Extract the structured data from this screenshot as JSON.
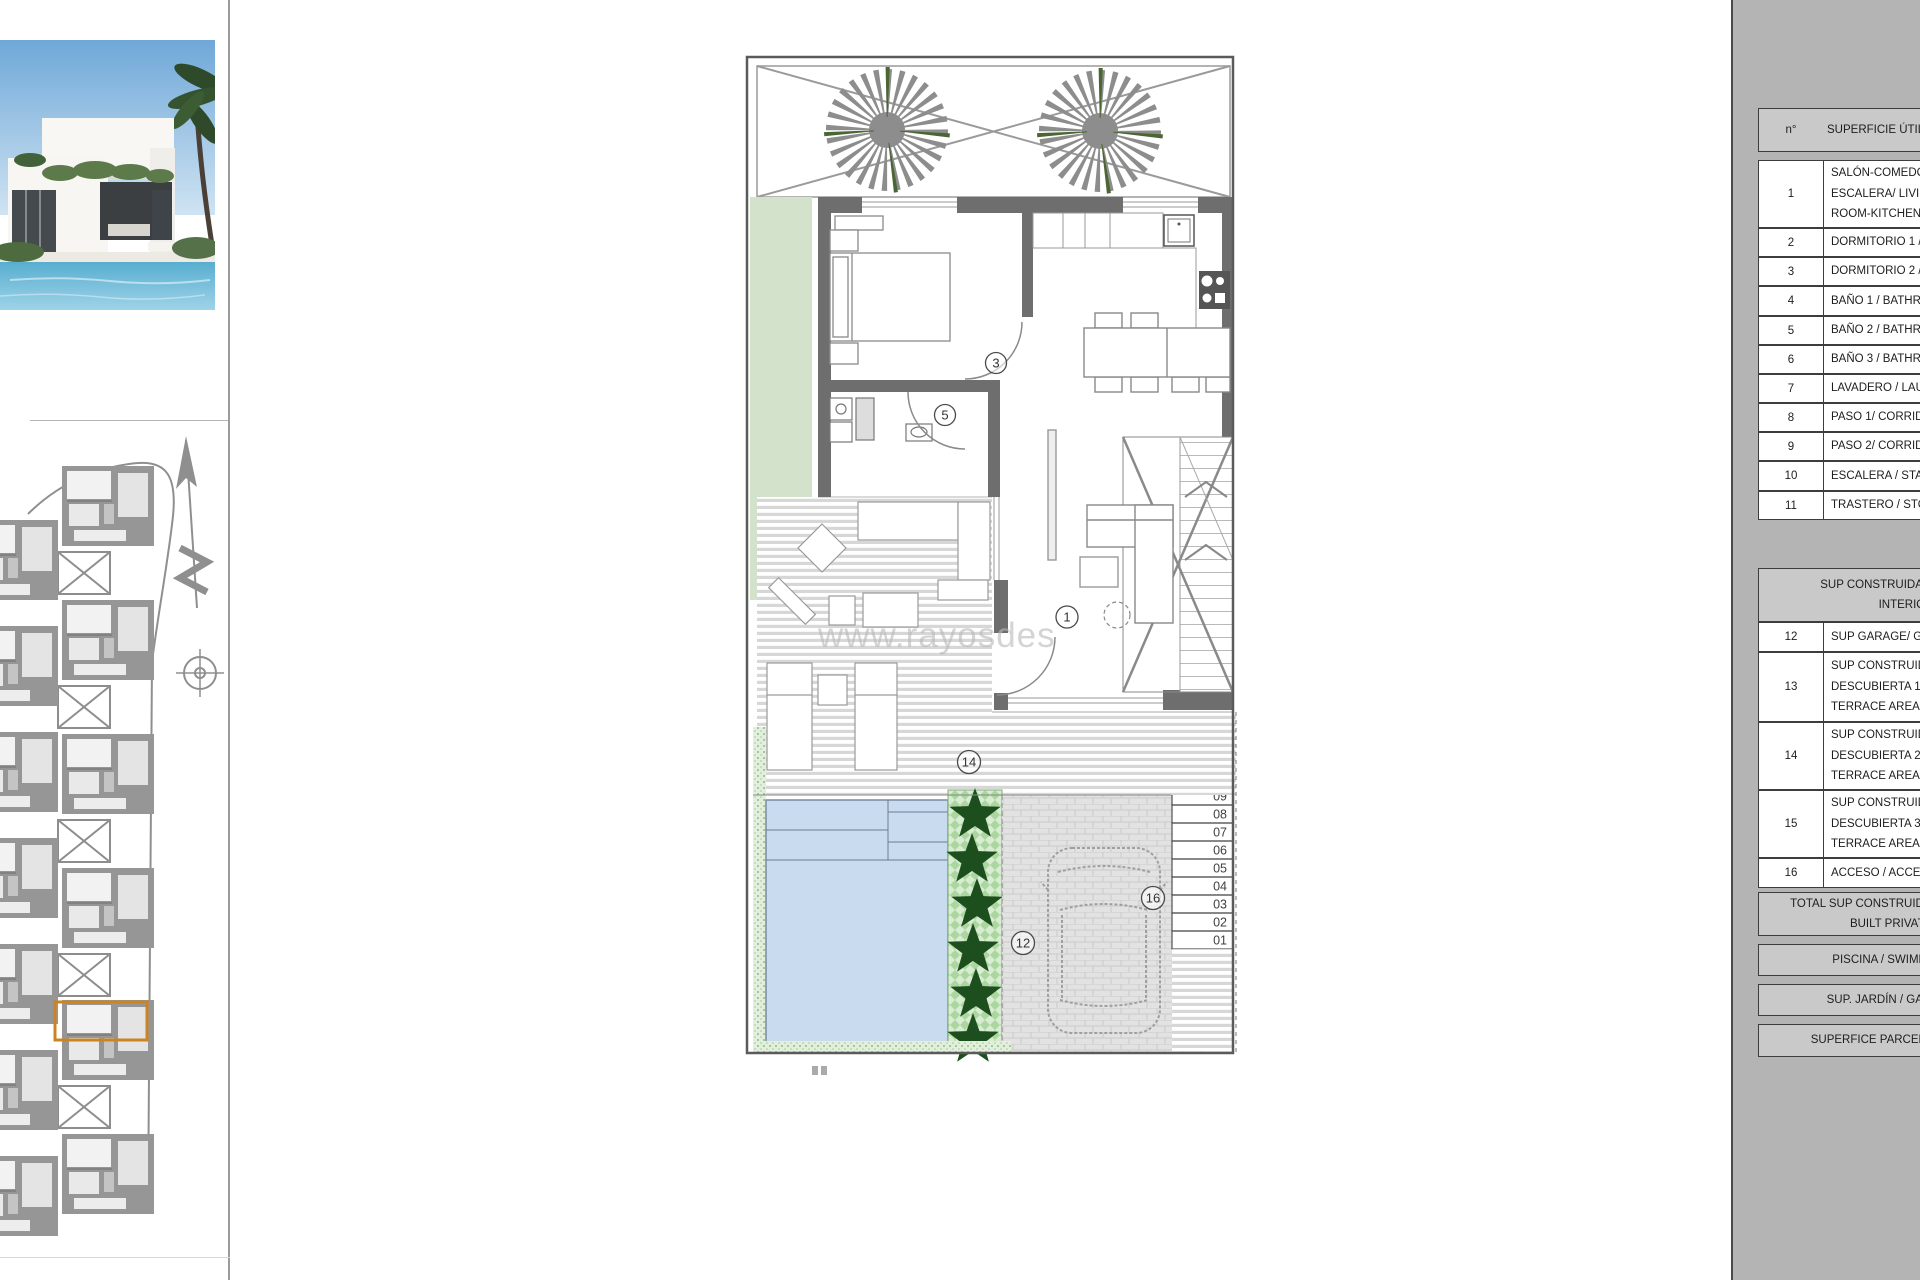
{
  "panel": {
    "header": {
      "num": "n°",
      "title": "SUPERFICIE ÚTIL / USEFUL AREA"
    },
    "rows": [
      {
        "n": "1",
        "lines": [
          "SALÓN-COMEDOR-COCINA-",
          "ESCALERA/ LIVING-DINING",
          "ROOM-KITCHEN-STAIRS"
        ]
      },
      {
        "n": "2",
        "lines": [
          "DORMITORIO 1 / BEDROOM 1"
        ]
      },
      {
        "n": "3",
        "lines": [
          "DORMITORIO 2 / BEDROOM 2"
        ]
      },
      {
        "n": "4",
        "lines": [
          "BAÑO 1 / BATHROOM 1"
        ]
      },
      {
        "n": "5",
        "lines": [
          "BAÑO 2 / BATHROOM 2"
        ]
      },
      {
        "n": "6",
        "lines": [
          "BAÑO 3 / BATHROOM 3"
        ]
      },
      {
        "n": "7",
        "lines": [
          "LAVADERO / LAUNDRY"
        ]
      },
      {
        "n": "8",
        "lines": [
          "PASO 1/ CORRIDOR 1"
        ]
      },
      {
        "n": "9",
        "lines": [
          "PASO 2/ CORRIDOR 2"
        ]
      },
      {
        "n": "10",
        "lines": [
          "ESCALERA / STAIRS"
        ]
      },
      {
        "n": "11",
        "lines": [
          "TRASTERO / STORAGE"
        ]
      }
    ],
    "header2_lines": [
      "SUP CONSTRUIDA INTERIOR / TOTAL",
      "INTERIOR AREA"
    ],
    "rows2": [
      {
        "n": "12",
        "lines": [
          "SUP GARAGE/ GARAGE AREA"
        ]
      },
      {
        "n": "13",
        "lines": [
          "SUP CONSTRUIDA",
          "DESCUBIERTA 1 / OPEN",
          "TERRACE AREA 1"
        ]
      },
      {
        "n": "14",
        "lines": [
          "SUP CONSTRUIDA",
          "DESCUBIERTA 2 / OPEN",
          "TERRACE AREA 2"
        ]
      },
      {
        "n": "15",
        "lines": [
          "SUP CONSTRUIDA",
          "DESCUBIERTA 3 / OPEN",
          "TERRACE AREA 3"
        ]
      },
      {
        "n": "16",
        "lines": [
          "ACCESO / ACCESS"
        ]
      }
    ],
    "total_lines": [
      "TOTAL SUP CONSTRUIDA PRIVADA/ TOTAL",
      "BUILT PRIVATE AREA"
    ],
    "summary": [
      "PISCINA / SWIMMING POOL",
      "SUP. JARDÍN / GARDEN AREA",
      "SUPERFICE PARCELA / PLOT AREA"
    ]
  },
  "floorplan": {
    "watermark": "www.rayosdes",
    "circles": {
      "c1": "1",
      "c3": "3",
      "c5": "5",
      "c12": "12",
      "c14": "14",
      "c16": "16"
    },
    "stairs": [
      "09",
      "08",
      "07",
      "06",
      "05",
      "04",
      "03",
      "02",
      "01"
    ]
  },
  "colors": {
    "highlight_orange": "#cc8322",
    "garden_green": "#d3e3cb",
    "pool_blue": "#c9dcef",
    "panel_gray": "#b4b4b4"
  }
}
